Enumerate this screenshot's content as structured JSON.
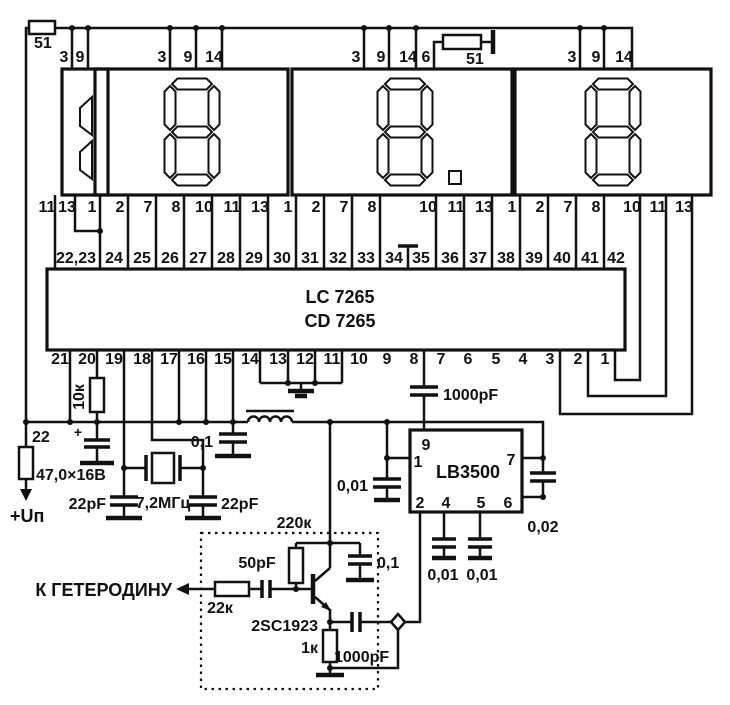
{
  "schematic": {
    "labels": {
      "res_top_left": "51",
      "res_top_right": "51",
      "res_10k": "10к",
      "res_22": "22",
      "power": "+Uп",
      "plus_sign": "+",
      "cap_electrolytic": "47,0×16В",
      "cap_22pf_left": "22pF",
      "crystal": "7,2МГц",
      "cap_22pf_right": "22pF",
      "cap_01_rail": "0,1",
      "ic_main_line1": "LC 7265",
      "ic_main_line2": "CD 7265",
      "cap_1000pf_top": "1000pF",
      "cap_001_left": "0,01",
      "ic_prescaler": "LB3500",
      "cap_002": "0,02",
      "cap_001_a": "0,01",
      "cap_001_b": "0,01",
      "res_220k": "220к",
      "cap_50pf": "50pF",
      "res_22k": "22к",
      "output": "К ГЕТЕРОДИНУ",
      "transistor": "2SC1923",
      "cap_01_box": "0,1",
      "res_1k": "1к",
      "cap_1000pf_bottom": "1000pF"
    },
    "lb_pins": {
      "p9": "9",
      "p1": "1",
      "p7": "7",
      "p2": "2",
      "p4": "4",
      "p5": "5",
      "p6": "6"
    },
    "displays": [
      {
        "digit": "1"
      },
      {
        "digit": "8"
      },
      {
        "digit": "8",
        "decimal_point": true
      },
      {
        "digit": "8"
      }
    ],
    "pin_rows": [
      {
        "name": "display-top-pin",
        "y": 62,
        "anchor": "middle",
        "pins": [
          {
            "x": 64,
            "t": "3"
          },
          {
            "x": 80,
            "t": "9"
          },
          {
            "x": 162,
            "t": "3"
          },
          {
            "x": 188,
            "t": "9"
          },
          {
            "x": 214,
            "t": "14"
          },
          {
            "x": 356,
            "t": "3"
          },
          {
            "x": 381,
            "t": "9"
          },
          {
            "x": 408,
            "t": "14"
          },
          {
            "x": 426,
            "t": "6"
          },
          {
            "x": 572,
            "t": "3"
          },
          {
            "x": 596,
            "t": "9"
          },
          {
            "x": 624,
            "t": "14"
          }
        ]
      },
      {
        "name": "display-bottom-pin",
        "y": 212,
        "anchor": "middle",
        "pins": [
          {
            "x": 47,
            "t": "11"
          },
          {
            "x": 67,
            "t": "13"
          },
          {
            "x": 92,
            "t": "1"
          },
          {
            "x": 120,
            "t": "2"
          },
          {
            "x": 148,
            "t": "7"
          },
          {
            "x": 176,
            "t": "8"
          },
          {
            "x": 204,
            "t": "10"
          },
          {
            "x": 232,
            "t": "11"
          },
          {
            "x": 260,
            "t": "13"
          },
          {
            "x": 288,
            "t": "1"
          },
          {
            "x": 316,
            "t": "2"
          },
          {
            "x": 344,
            "t": "7"
          },
          {
            "x": 372,
            "t": "8"
          },
          {
            "x": 428,
            "t": "10"
          },
          {
            "x": 456,
            "t": "11"
          },
          {
            "x": 484,
            "t": "13"
          },
          {
            "x": 512,
            "t": "1"
          },
          {
            "x": 540,
            "t": "2"
          },
          {
            "x": 568,
            "t": "7"
          },
          {
            "x": 596,
            "t": "8"
          },
          {
            "x": 632,
            "t": "10"
          },
          {
            "x": 658,
            "t": "11"
          },
          {
            "x": 684,
            "t": "13"
          }
        ]
      },
      {
        "name": "ic-top-pin",
        "y": 263,
        "anchor": "middle",
        "pins": [
          {
            "x": 76,
            "t": "22,23"
          },
          {
            "x": 114,
            "t": "24"
          },
          {
            "x": 142,
            "t": "25"
          },
          {
            "x": 170,
            "t": "26"
          },
          {
            "x": 198,
            "t": "27"
          },
          {
            "x": 226,
            "t": "28"
          },
          {
            "x": 254,
            "t": "29"
          },
          {
            "x": 282,
            "t": "30"
          },
          {
            "x": 310,
            "t": "31"
          },
          {
            "x": 338,
            "t": "32"
          },
          {
            "x": 366,
            "t": "33"
          },
          {
            "x": 394,
            "t": "34"
          },
          {
            "x": 421,
            "t": "35"
          },
          {
            "x": 450,
            "t": "36"
          },
          {
            "x": 478,
            "t": "37"
          },
          {
            "x": 506,
            "t": "38"
          },
          {
            "x": 534,
            "t": "39"
          },
          {
            "x": 562,
            "t": "40"
          },
          {
            "x": 590,
            "t": "41"
          },
          {
            "x": 616,
            "t": "42"
          }
        ]
      },
      {
        "name": "ic-bottom-pin",
        "y": 364,
        "anchor": "middle",
        "pins": [
          {
            "x": 60,
            "t": "21"
          },
          {
            "x": 87,
            "t": "20"
          },
          {
            "x": 114,
            "t": "19"
          },
          {
            "x": 142,
            "t": "18"
          },
          {
            "x": 169,
            "t": "17"
          },
          {
            "x": 196,
            "t": "16"
          },
          {
            "x": 223,
            "t": "15"
          },
          {
            "x": 250,
            "t": "14"
          },
          {
            "x": 278,
            "t": "13"
          },
          {
            "x": 305,
            "t": "12"
          },
          {
            "x": 332,
            "t": "11"
          },
          {
            "x": 359,
            "t": "10"
          },
          {
            "x": 387,
            "t": "9"
          },
          {
            "x": 414,
            "t": "8"
          },
          {
            "x": 441,
            "t": "7"
          },
          {
            "x": 468,
            "t": "6"
          },
          {
            "x": 496,
            "t": "5"
          },
          {
            "x": 523,
            "t": "4"
          },
          {
            "x": 550,
            "t": "3"
          },
          {
            "x": 578,
            "t": "2"
          },
          {
            "x": 605,
            "t": "1"
          }
        ]
      }
    ]
  }
}
